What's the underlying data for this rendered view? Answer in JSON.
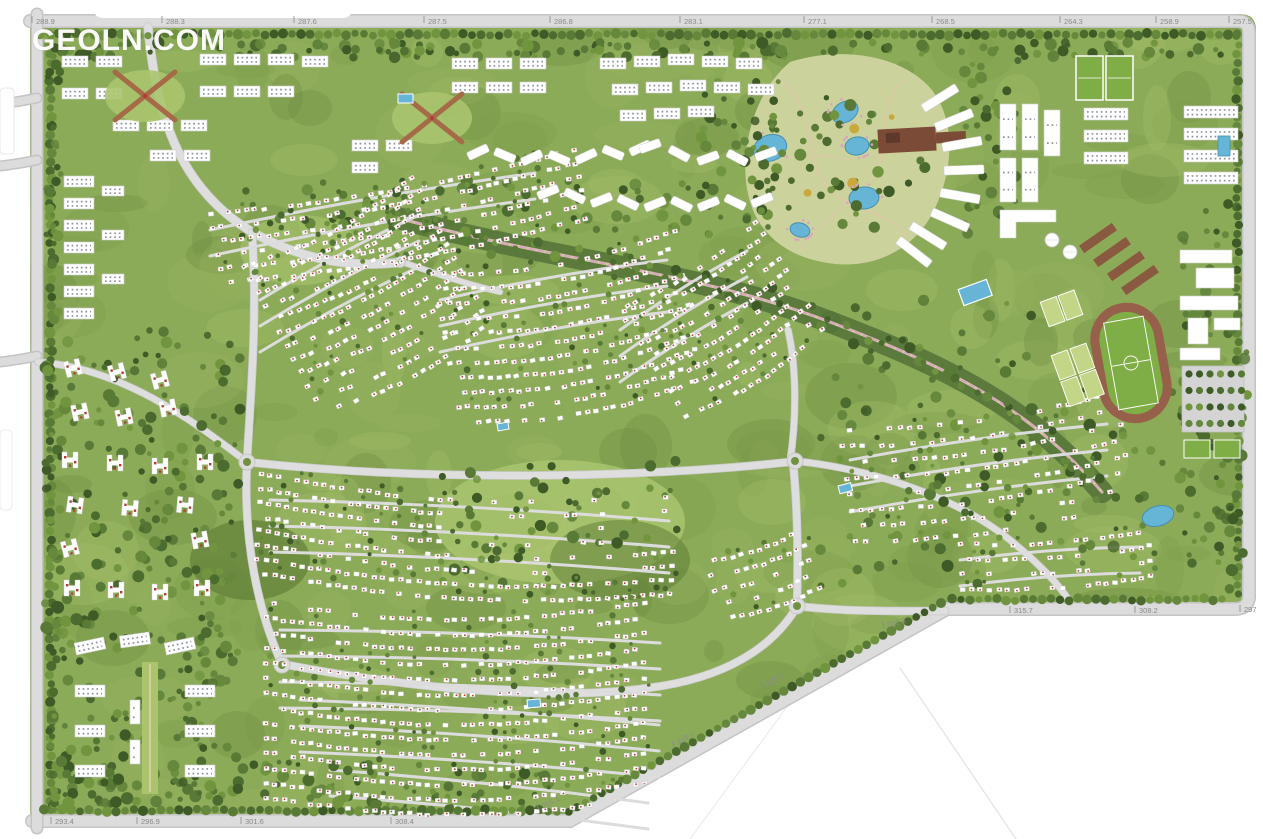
{
  "watermark": {
    "text": "GEOLN.COM"
  },
  "map": {
    "kind": "residential-master-plan",
    "features": [
      "perimeter-road",
      "central-park",
      "lakes",
      "linear-park-corridor",
      "running-track-stadium",
      "sports-courts",
      "football-fields",
      "villa-district",
      "apartment-district",
      "school-campus",
      "parking-lot",
      "roundabouts",
      "tree-canopy",
      "swimming-pools"
    ],
    "dimension_labels": {
      "top": [
        {
          "value": "288.9",
          "x": 38
        },
        {
          "value": "288.3",
          "x": 168
        },
        {
          "value": "287.6",
          "x": 300
        },
        {
          "value": "287.5",
          "x": 430
        },
        {
          "value": "286.8",
          "x": 556
        },
        {
          "value": "283.1",
          "x": 686
        },
        {
          "value": "277.1",
          "x": 810
        },
        {
          "value": "268.5",
          "x": 938
        },
        {
          "value": "264.3",
          "x": 1066
        },
        {
          "value": "258.9",
          "x": 1162
        },
        {
          "value": "257.5",
          "x": 1235
        }
      ],
      "bottom": [
        {
          "value": "293.4",
          "x": 57,
          "y": 824,
          "rot": 0
        },
        {
          "value": "296.9",
          "x": 143,
          "y": 824,
          "rot": 0
        },
        {
          "value": "301.6",
          "x": 247,
          "y": 824,
          "rot": 0
        },
        {
          "value": "308.4",
          "x": 397,
          "y": 824,
          "rot": 0
        },
        {
          "value": "315.1",
          "x": 545,
          "y": 808,
          "rot": -27
        },
        {
          "value": "318.1",
          "x": 680,
          "y": 744,
          "rot": -29
        },
        {
          "value": "320.1",
          "x": 770,
          "y": 685,
          "rot": -29
        },
        {
          "value": "321.3",
          "x": 890,
          "y": 627,
          "rot": -15
        },
        {
          "value": "315.7",
          "x": 1016,
          "y": 613,
          "rot": 0
        },
        {
          "value": "308.2",
          "x": 1141,
          "y": 613,
          "rot": 0
        },
        {
          "value": "297",
          "x": 1246,
          "y": 612,
          "rot": 0
        }
      ]
    },
    "colors": {
      "road": "#dcdcdc",
      "road_edge": "#c4c4c4",
      "site_green": "#8cab58",
      "forest": "#46662c",
      "lawn": "#aac46e",
      "park": "#ccd29c",
      "water": "#66b4d6",
      "water_edge": "#4390b2",
      "track": "#96604a",
      "pitch": "#7fae46",
      "building": "#ffffff",
      "building_edge": "#cfcfcf",
      "accent_red": "#b23b35",
      "label": "#8a8a8a",
      "corridor_pink": "#d9a6c2",
      "court": "#c3d687",
      "brown_path": "#a56a48",
      "pier_brown": "#7b4b38",
      "window": "#8b939e"
    }
  }
}
